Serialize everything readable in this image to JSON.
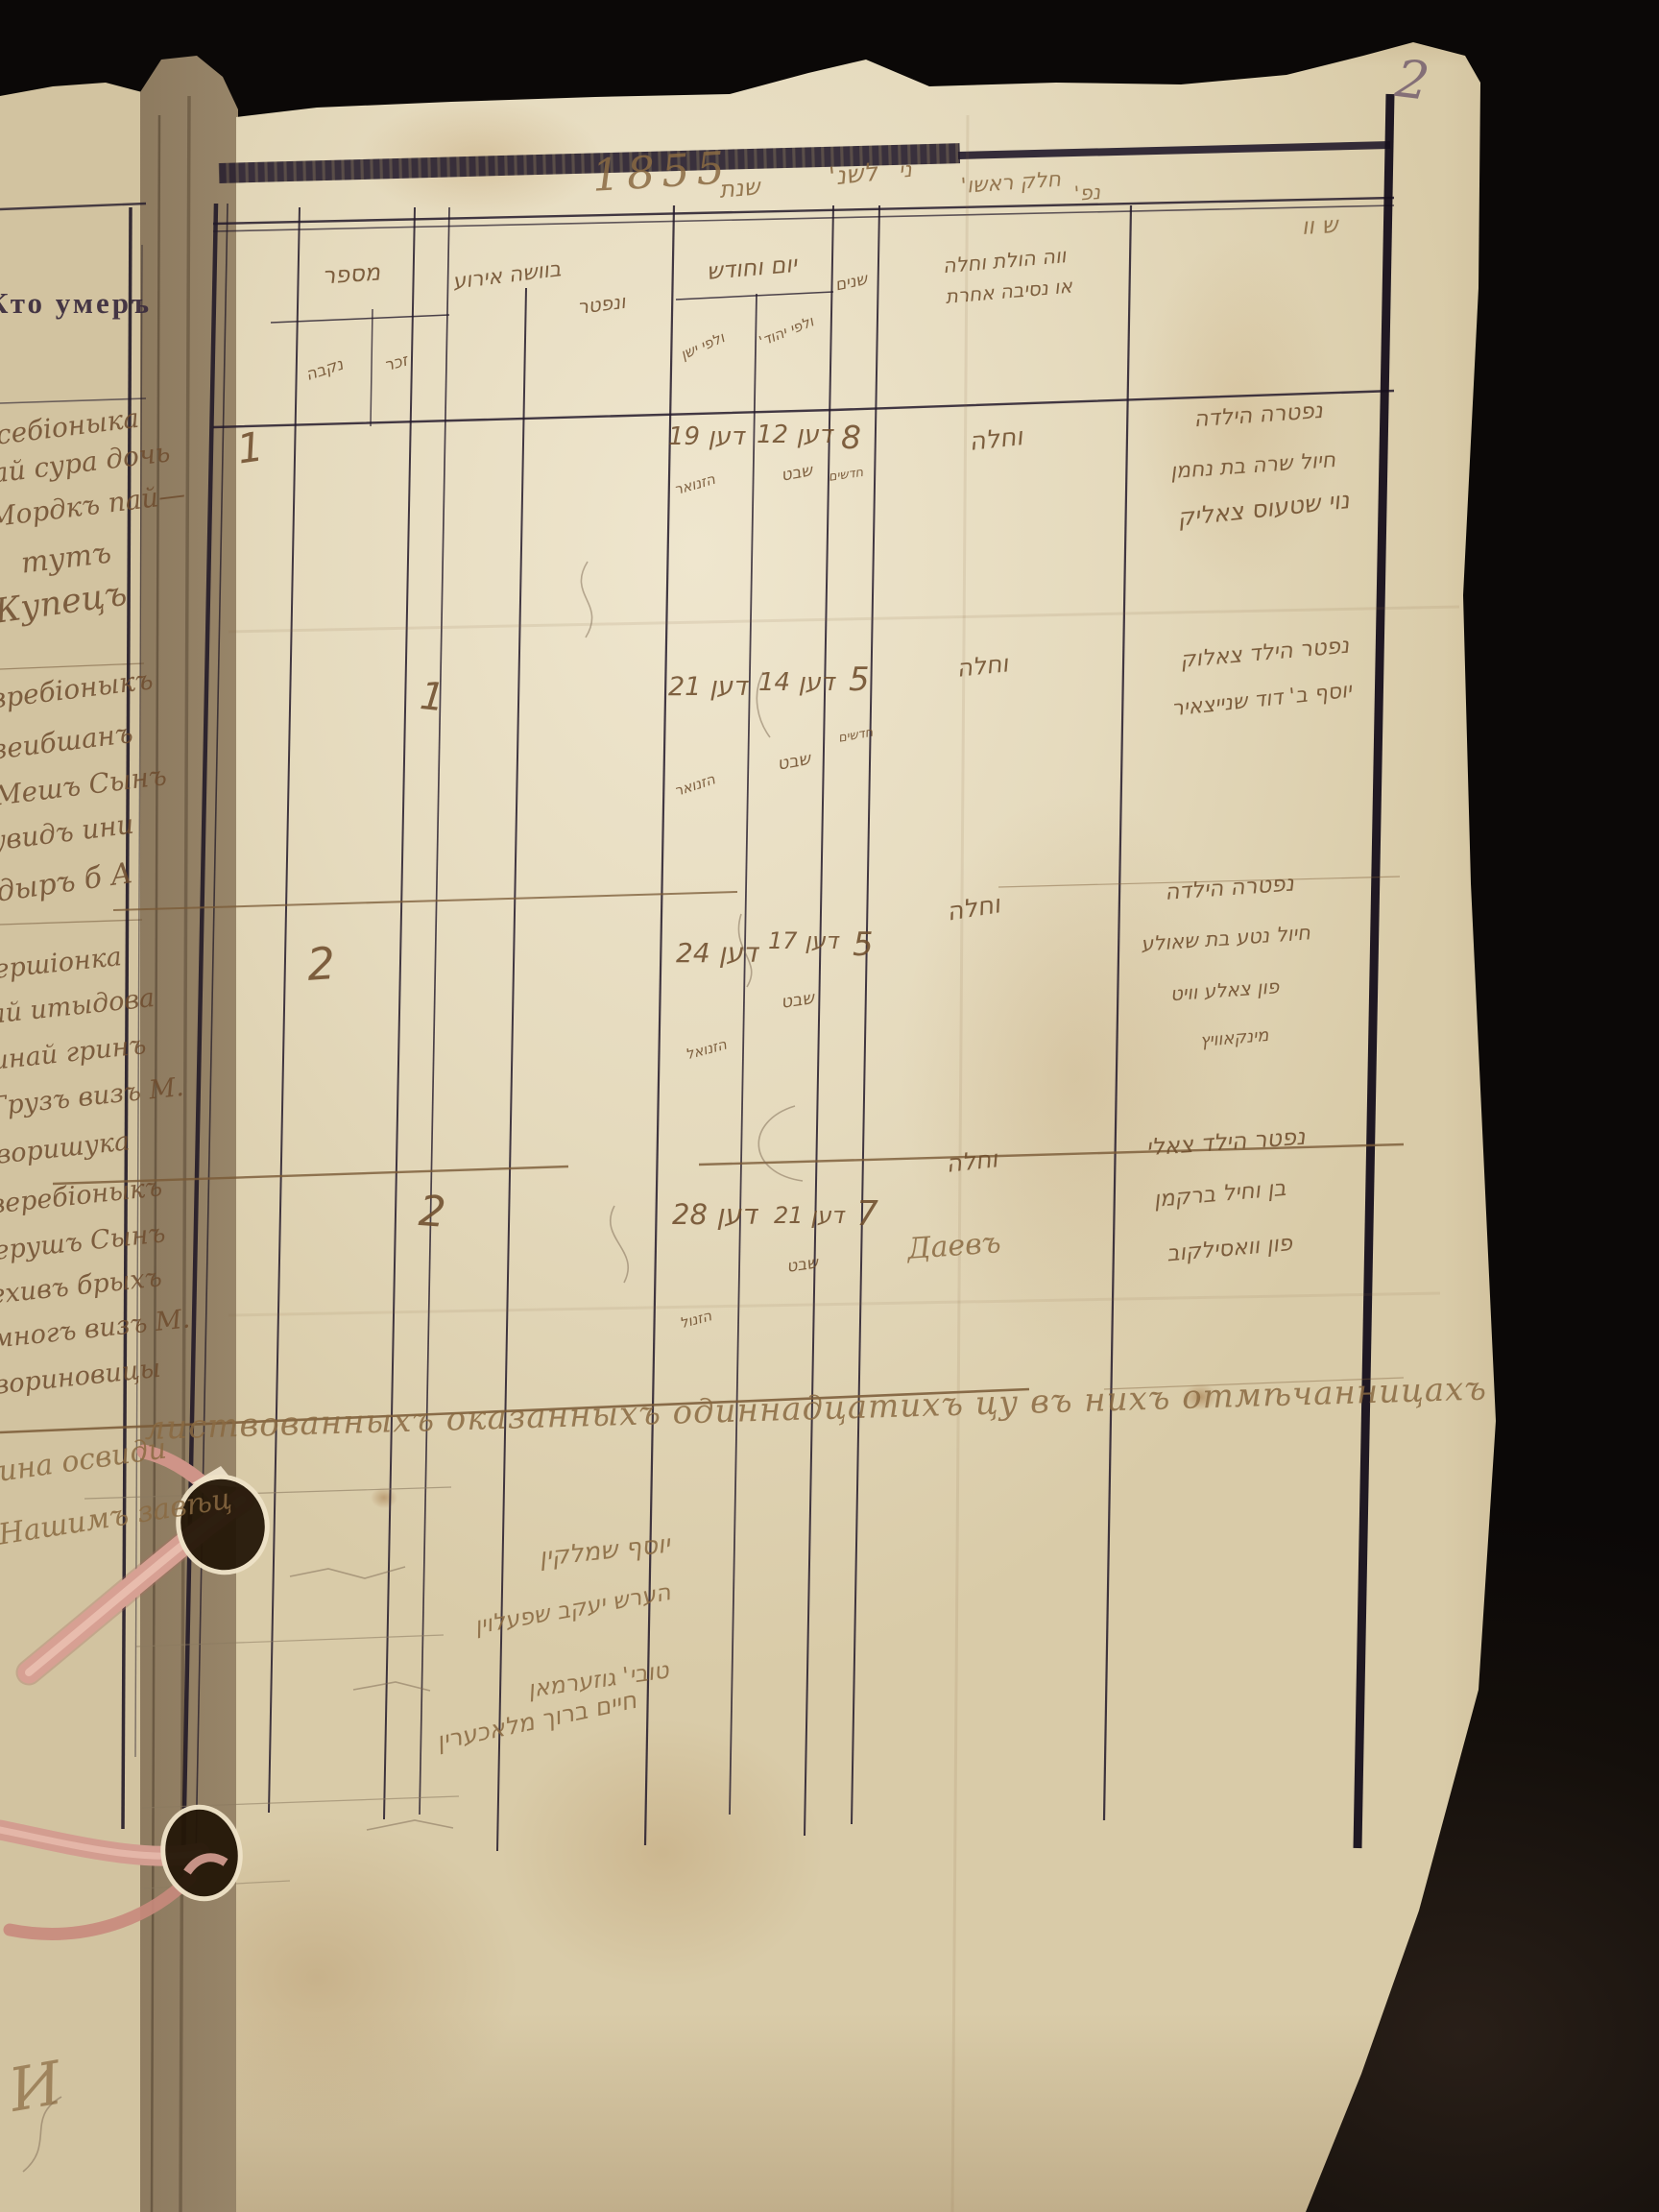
{
  "photo": {
    "page_number": "2"
  },
  "header": {
    "year": "1855",
    "words": [
      "שנת",
      "לשנ'",
      "ני",
      "חלק ראשו'",
      "נפ'"
    ],
    "corner_mark": "ש וו"
  },
  "left_page": {
    "printed_header": "Кто умеръ",
    "entries": [
      "себіоныка",
      "ай сура дочь",
      "Мордкъ пай—",
      "тутъ",
      "Купецъ",
      "вребіоныкъ",
      "зеибшанъ",
      "Мешъ Сынъ",
      "увидъ ини",
      "дыръ б А",
      "ершіонка",
      "ай итыдова",
      "инай гринъ",
      "Грузъ визъ М.",
      "воришука",
      "веребіоныкъ",
      "ерушъ Сынъ",
      "ехивъ брыхъ",
      "многъ визъ М.",
      "вориновицы"
    ],
    "cert_fragment": "ина освиди",
    "clerk_fragment": "Нашимъ завѣц",
    "corner_flourish": "И"
  },
  "table": {
    "header": {
      "number": "מספר",
      "female": "נקבה",
      "male": "זכר",
      "manner_1": "בוושה אירוע",
      "manner_2": "ונפטר",
      "date": "יום וחודש",
      "date_old": "ולפי ישן",
      "date_heb": "ולפי יהוד'",
      "age": "שנים",
      "cause_1": "ווה הולת וחלה",
      "cause_2": "או נסיבה אחרת"
    },
    "rows": [
      {
        "count": "1",
        "date_old": "דען 19",
        "date_old_month": "הזנואר",
        "date_heb": "דען 12",
        "date_heb_month": "שבט",
        "age": "8",
        "age_unit": "חדשים",
        "cause": "וחלה",
        "desc": [
          "נפטרה הילדה",
          "חיול שרה בת נחמן",
          "נוי שטעוס צאליק"
        ]
      },
      {
        "count": "1",
        "date_old": "דען 21",
        "date_old_month": "הזנואר",
        "date_heb": "דען 14",
        "date_heb_month": "שבט",
        "age": "5",
        "age_unit": "חדשים",
        "cause": "וחלה",
        "desc": [
          "נפטר הילד צאלוק",
          "יוסף ב' דוד שנייצאיר"
        ]
      },
      {
        "count": "2",
        "date_old": "דען 24",
        "date_old_month": "הזנואל",
        "date_heb": "דען 17",
        "date_heb_month": "שבט",
        "age": "5",
        "age_unit": "",
        "cause": "וחלה",
        "desc": [
          "נפטרה הילדה",
          "חיול נטע בת שאולע",
          "פון צאלע וויט",
          "מינקאוויץ"
        ]
      },
      {
        "count": "2",
        "date_old": "דען 28",
        "date_old_month": "הזנול",
        "date_heb": "דען 21",
        "date_heb_month": "שבט",
        "age": "7",
        "age_unit": "",
        "cause": "וחלה",
        "desc": [
          "נפטר הילד צאלי",
          "בן וחיל ברקמן",
          "פון וואסילקוב"
        ]
      }
    ]
  },
  "bottom": {
    "certification": "листвованныхъ оказанныхъ одиннадцатихъ цу въ нихъ отмѣчанницахъ",
    "signatures": [
      "יוסף שמלקין",
      "הערש יעקב שפעלוין",
      "טובי' גוזערמאן",
      "חיים ברוך מלאכערין"
    ],
    "annotation": "Даевъ"
  }
}
